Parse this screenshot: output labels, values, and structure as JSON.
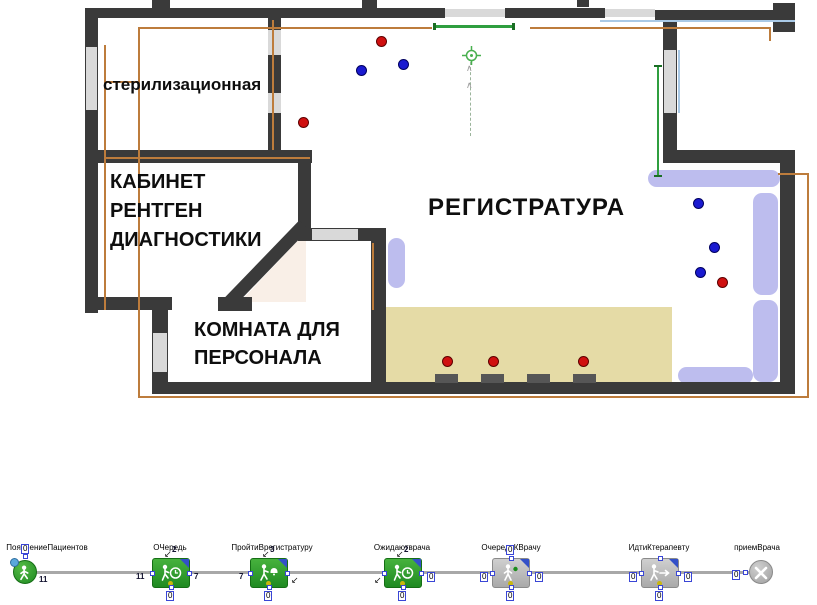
{
  "plan": {
    "rooms": {
      "sterilization": "стерилизационная",
      "xray_line1": "КАБИНЕТ",
      "xray_line2": "РЕНТГЕН",
      "xray_line3": "ДИАГНОСТИКИ",
      "registry": "РЕГИСТРАТУРА",
      "staff_line1": "КОМНАТА ДЛЯ",
      "staff_line2": "ПЕРСОНАЛА"
    },
    "agents": {
      "red": [
        [
          303,
          122
        ],
        [
          381,
          41
        ],
        [
          447,
          361
        ],
        [
          493,
          361
        ],
        [
          583,
          361
        ],
        [
          722,
          282
        ]
      ],
      "blue": [
        [
          361,
          70
        ],
        [
          403,
          64
        ],
        [
          698,
          203
        ],
        [
          714,
          247
        ],
        [
          700,
          272
        ]
      ]
    },
    "colors": {
      "wall": "#3a3a3a",
      "window": "#d9d9d9",
      "area_outline": "#bd7c3c",
      "target_line": "#2f9e3f",
      "bench": "#bdbdee",
      "service_area": "#e5dba6",
      "agent_red": "#d01010",
      "agent_blue": "#1a1ad0"
    }
  },
  "flowchart": {
    "blocks": [
      {
        "label": "ПоявлениеПациентов",
        "top_count": "0",
        "out_count": "11"
      },
      {
        "label": "ОЧередь",
        "in_count": "11",
        "out_count": "7",
        "top_count": "2",
        "bottom_count": "0"
      },
      {
        "label": "ПройтиВрегистратуру",
        "in_count": "7",
        "top_count": "3",
        "bottom_count": "0"
      },
      {
        "label": "Ожидаютврача",
        "out_count": "0",
        "top_count": "2",
        "bottom_count": "0"
      },
      {
        "label": "ОчередьКВрачу",
        "in_count": "0",
        "out_count": "0",
        "top_count": "0",
        "bottom_count": "0"
      },
      {
        "label": "ИдтиКтерапевту",
        "in_count": "0",
        "out_count": "0",
        "bottom_count": "0"
      },
      {
        "label": "приемВрача",
        "in_count": "0"
      }
    ]
  }
}
